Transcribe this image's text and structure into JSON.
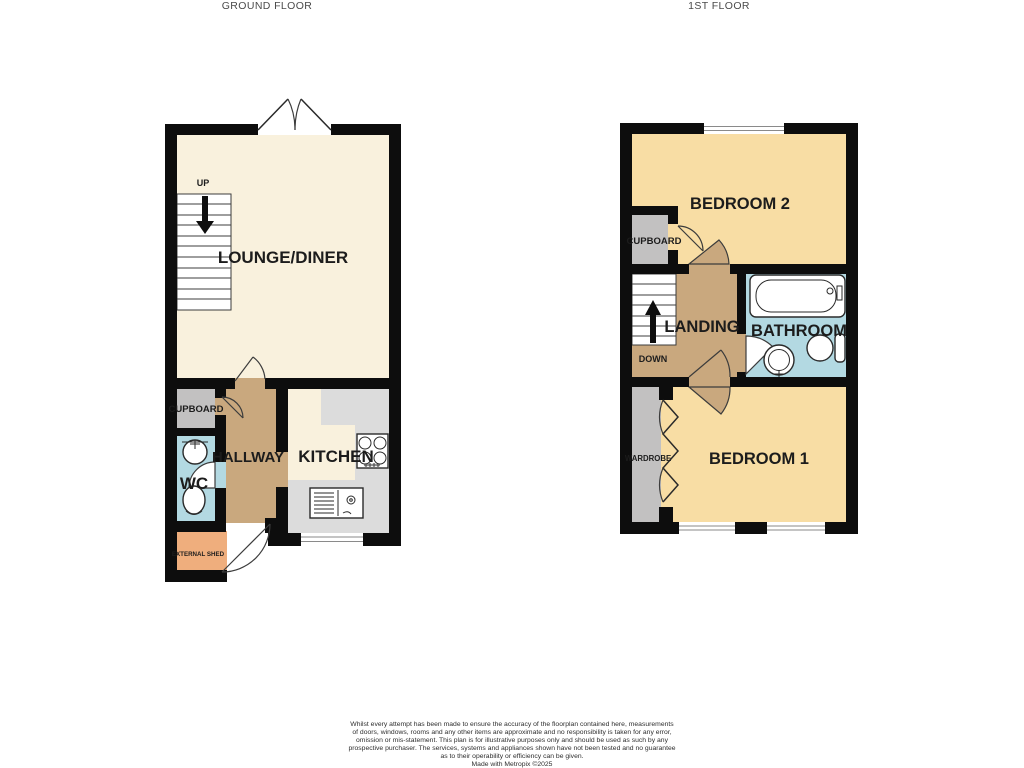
{
  "titles": {
    "ground": "GROUND FLOOR",
    "first": "1ST FLOOR"
  },
  "ground_floor": {
    "lounge": "LOUNGE/DINER",
    "up": "UP",
    "cupboard": "CUPBOARD",
    "wc": "WC",
    "hallway": "HALLWAY",
    "kitchen": "KITCHEN",
    "shed": "EXTERNAL SHED"
  },
  "first_floor": {
    "bedroom2": "BEDROOM 2",
    "cupboard": "CUPBOARD",
    "landing": "LANDING",
    "down": "DOWN",
    "bathroom": "BATHROOM",
    "wardrobe": "WARDROBE",
    "bedroom1": "BEDROOM 1"
  },
  "disclaimer": {
    "line1": "Whilst every attempt has been made to ensure the accuracy of the floorplan contained here, measurements",
    "line2": "of doors, windows, rooms and any other items are approximate and no responsibility is taken for any error,",
    "line3": "omission or mis-statement. This plan is for illustrative purposes only and should be used as such by any",
    "line4": "prospective purchaser. The services, systems and appliances shown have not been tested and no guarantee",
    "line5": "as to their operability or efficiency can be given.",
    "line6": "Made with Metropix ©2025"
  },
  "colors": {
    "wall": "#0d0d0d",
    "lounge_floor": "#f9f1dd",
    "bedroom_floor": "#f8dda4",
    "hall_landing_floor": "#c9a87e",
    "cupboard_gray": "#c2c1c1",
    "kitchen_counter": "#dcdcdc",
    "bathroom_blue": "#b3d9e2",
    "shed_orange": "#efae7d",
    "title_text": "#4a4a4a",
    "label_text": "#1c1c1c"
  }
}
